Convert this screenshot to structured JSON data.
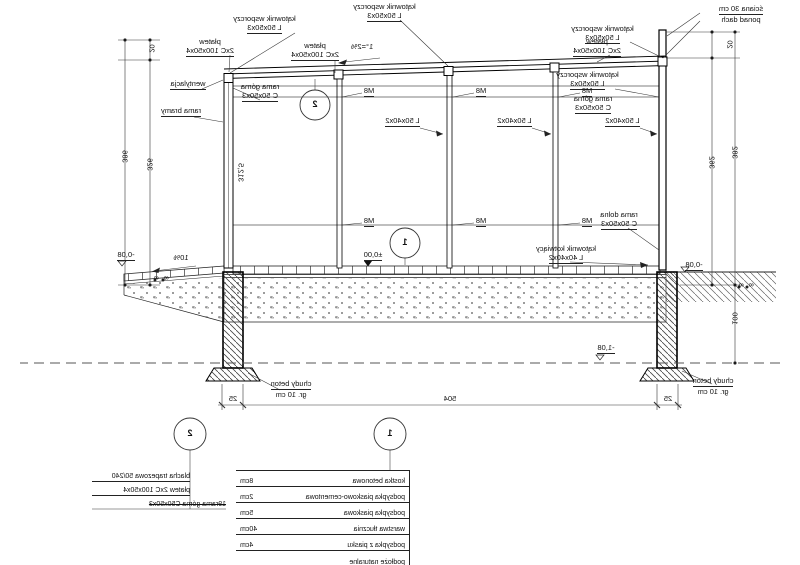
{
  "labels": {
    "sciana_l1": "ściana 30 cm",
    "sciana_l2": "ponad dach",
    "katownik_l1": "kątownik wsporczy",
    "katownik_l2": "L  50x50x3",
    "platew_l1": "płatew",
    "platew_l2": "2xC 100x50x4",
    "slope_roof": "1°=2%",
    "wentylacja": "wentylacja",
    "rama_gorna_l1": "rama górna",
    "rama_gorna_l2": "C 50x50x3",
    "rama_bramy": "rama bramy",
    "rama_dolna_l1": "rama dolna",
    "rama_dolna_l2": "C 50x50x3",
    "katownik_kotw_l1": "kątownik kotwiący",
    "katownik_kotw_l2": "L  40x40x2",
    "m8": "M8",
    "girt": "L  50x40x2",
    "level_zero": "±0,00",
    "level_m008": "-0,08",
    "level_m108": "-1,08",
    "slope_ground": "10%",
    "chudy_l1": "chudy beton",
    "chudy_l2": "gr. 10 cm",
    "gate_height": "312,5"
  },
  "dims": {
    "wall_top_20": "20",
    "wall_inner": "362",
    "wall_total": "382",
    "wall_below": "100",
    "gate_top_20": "20",
    "gate_inner": "326",
    "gate_total": "386",
    "bottom_left_25": "25",
    "bottom_span": "504",
    "bottom_right_25": "25",
    "small_8": "8"
  },
  "markers": {
    "floor": "1",
    "roof": "2"
  },
  "legend_floor": {
    "rows": [
      {
        "name": "kostka betonowa",
        "value": "8cm"
      },
      {
        "name": "podsypka piaskowo-cementowa",
        "value": "2cm"
      },
      {
        "name": "podsypka piaskowa",
        "value": "5cm"
      },
      {
        "name": "warstwa tłucznia",
        "value": "40cm"
      },
      {
        "name": "podsypka z piasku",
        "value": "4cm"
      },
      {
        "name": "podłoże naturalne",
        "value": ""
      }
    ]
  },
  "legend_roof": {
    "rows": [
      "blacha trapezowa 50/240",
      "płatew 2xC 100x50x4",
      "19rama górna C50x50x3"
    ]
  }
}
